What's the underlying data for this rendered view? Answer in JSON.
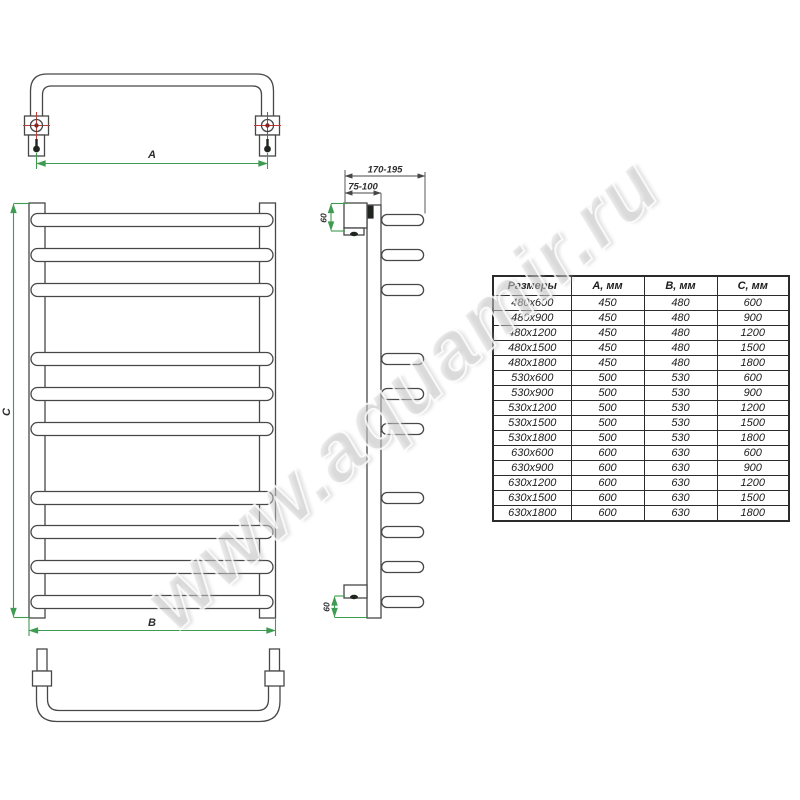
{
  "watermark": "www.aquamir.ru",
  "colors": {
    "dimension_line": "#3f9b51",
    "centerline_cross": "#c03a36",
    "drawing_line": "#474747"
  },
  "drawing": {
    "labels": {
      "width_a": "A",
      "width_b": "B",
      "height_c": "C",
      "depth_outer": "170-195",
      "depth_inner": "75-100",
      "offset_top": "60",
      "offset_bottom": "60"
    }
  },
  "table": {
    "headers": [
      "Размеры",
      "А, мм",
      "В, мм",
      "С, мм"
    ],
    "rows": [
      [
        "480x600",
        "450",
        "480",
        "600"
      ],
      [
        "480x900",
        "450",
        "480",
        "900"
      ],
      [
        "480x1200",
        "450",
        "480",
        "1200"
      ],
      [
        "480x1500",
        "450",
        "480",
        "1500"
      ],
      [
        "480x1800",
        "450",
        "480",
        "1800"
      ],
      [
        "530x600",
        "500",
        "530",
        "600"
      ],
      [
        "530x900",
        "500",
        "530",
        "900"
      ],
      [
        "530x1200",
        "500",
        "530",
        "1200"
      ],
      [
        "530x1500",
        "500",
        "530",
        "1500"
      ],
      [
        "530x1800",
        "500",
        "530",
        "1800"
      ],
      [
        "630x600",
        "600",
        "630",
        "600"
      ],
      [
        "630x900",
        "600",
        "630",
        "900"
      ],
      [
        "630x1200",
        "600",
        "630",
        "1200"
      ],
      [
        "630x1500",
        "600",
        "630",
        "1500"
      ],
      [
        "630x1800",
        "600",
        "630",
        "1800"
      ]
    ]
  }
}
